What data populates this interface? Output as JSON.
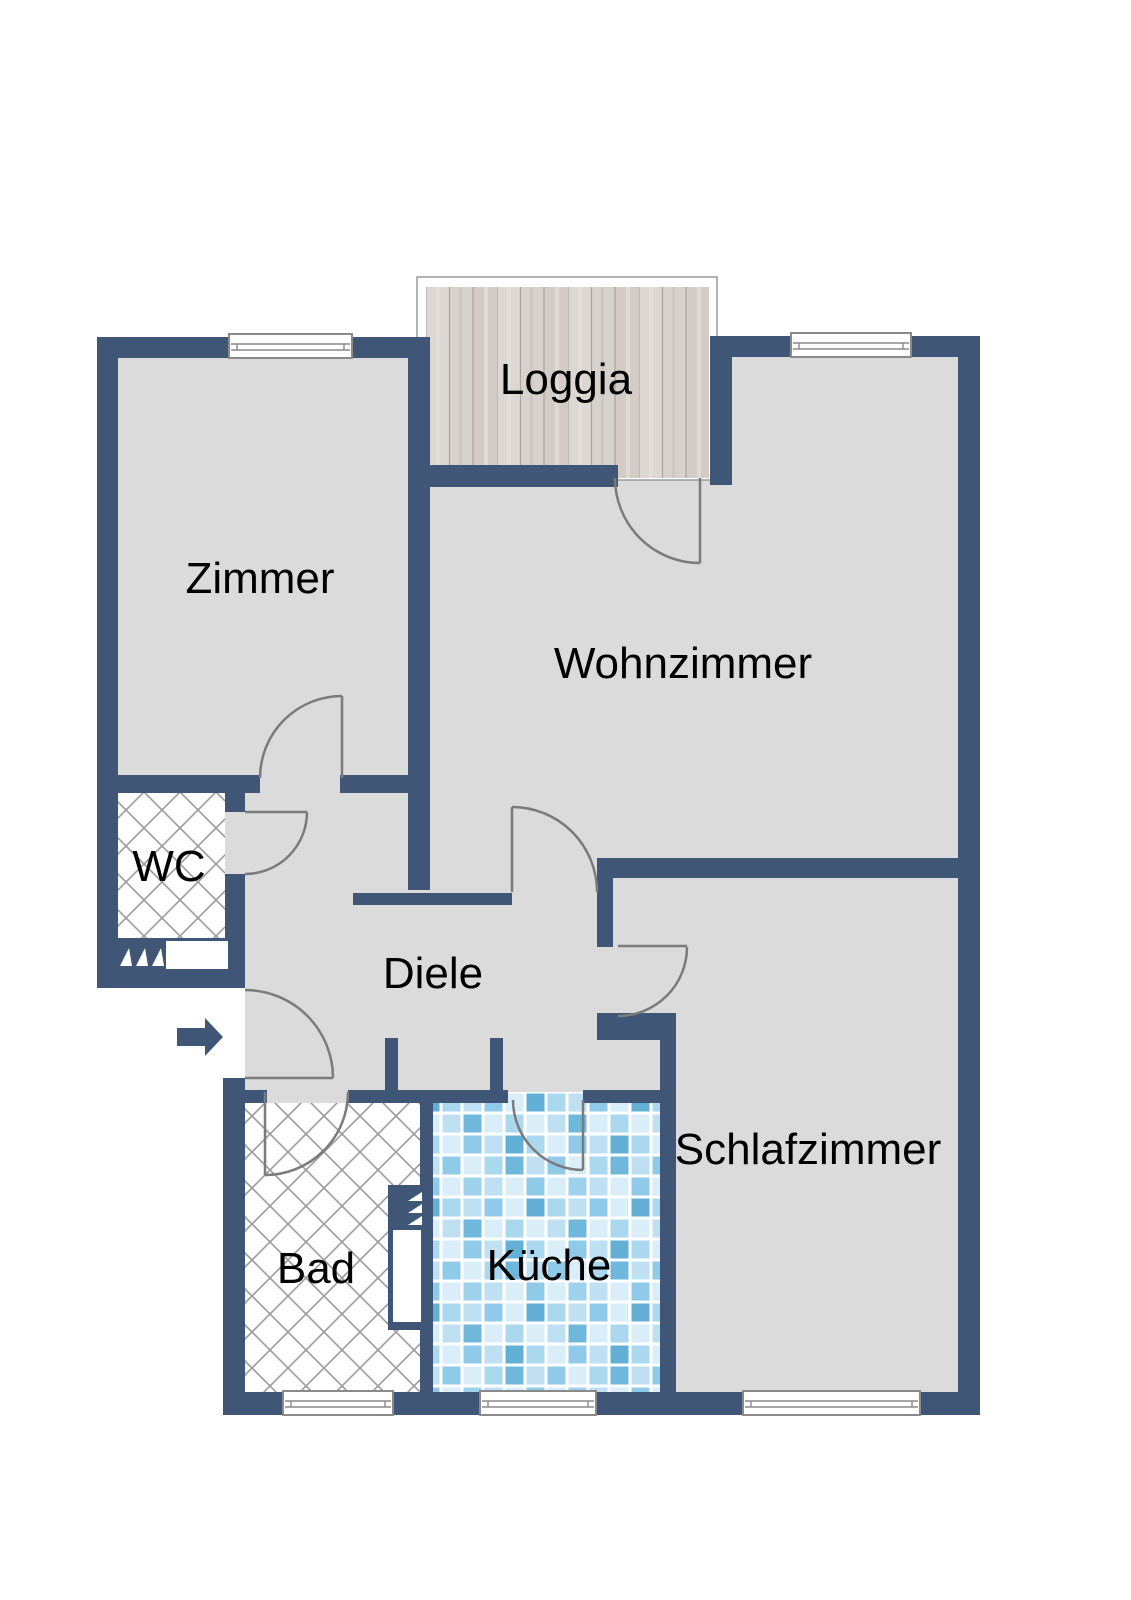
{
  "plan": {
    "rooms": {
      "loggia": {
        "label": "Loggia"
      },
      "zimmer": {
        "label": "Zimmer"
      },
      "wohnzimmer": {
        "label": "Wohnzimmer"
      },
      "wc": {
        "label": "WC"
      },
      "diele": {
        "label": "Diele"
      },
      "schlafzimmer": {
        "label": "Schlafzimmer"
      },
      "bad": {
        "label": "Bad"
      },
      "kueche": {
        "label": "Küche"
      }
    },
    "colors": {
      "wall": "#405677",
      "floor": "#dbdbdb",
      "door_arc": "#7b7b7b",
      "window_frame": "#8a8a8a",
      "crosshatch_line": "#9b9b9b",
      "wood_base": "#d8d2cc",
      "wood_line": "#aaa29c",
      "tile_blues": [
        "#daeef9",
        "#bfe0f2",
        "#a9d8ef",
        "#8fcbe8",
        "#6fb8dc",
        "#62b0d6"
      ],
      "label_text": "#000000"
    },
    "icons": {
      "entrance_arrow": "right-arrow",
      "vent_triangles": "vent-hatch"
    }
  }
}
